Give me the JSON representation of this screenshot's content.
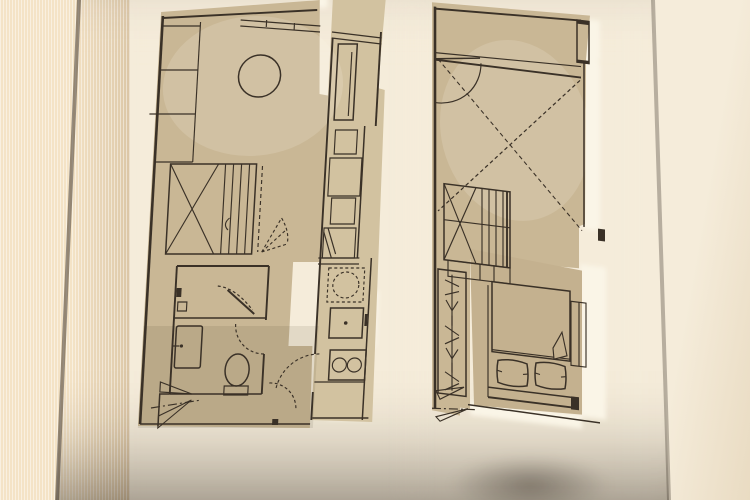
{
  "meta": {
    "title": "Photograph of a bronze wall plaque displaying two laser-engraved apartment floor plans",
    "image_type": "photo of architectural floor plan signage",
    "visible_text": "none"
  },
  "colors": {
    "wall_left_base": "#f4e3c6",
    "wall_left_shade": "#d9c2a0",
    "wall_right_base": "#f5ecda",
    "wall_right_shade": "#e9dbc2",
    "panel_top": "#a09284",
    "panel_mid": "#7e7165",
    "panel_low": "#675c51",
    "panel_bottom": "#564c42",
    "edge_line": "#46false",
    "edge_line_hex": "#463b30",
    "plan_fill": "#c9b795",
    "plan_fill_light": "#d2c2a0",
    "bed_panel": "#c4b18f",
    "backing": "#faf5e7",
    "line": "#3a3127"
  },
  "plans": {
    "left_unit": {
      "name": "lower-level-unit-plan",
      "fixtures": [
        "wall cabinets",
        "round table",
        "window band",
        "staircase with cross bracing",
        "winder steps",
        "bathroom",
        "shower with glass door",
        "wash basin",
        "toilet",
        "bifold louvre door",
        "entry door swings",
        "refrigerator",
        "base cabinet run",
        "dishwasher cabinet",
        "washing machine",
        "oven",
        "two burner hob",
        "kitchen counter"
      ]
    },
    "right_unit": {
      "name": "upper-level-unit-plan",
      "fixtures": [
        "bulkhead band",
        "door swing",
        "void cross (dashed)",
        "window strip",
        "staircase with cross bracing",
        "under-stair cabinet",
        "wardrobe hanging rail",
        "double bed",
        "pillows",
        "duvet with folded corner",
        "headboard",
        "bifold louvre door",
        "bedside unit"
      ]
    }
  }
}
